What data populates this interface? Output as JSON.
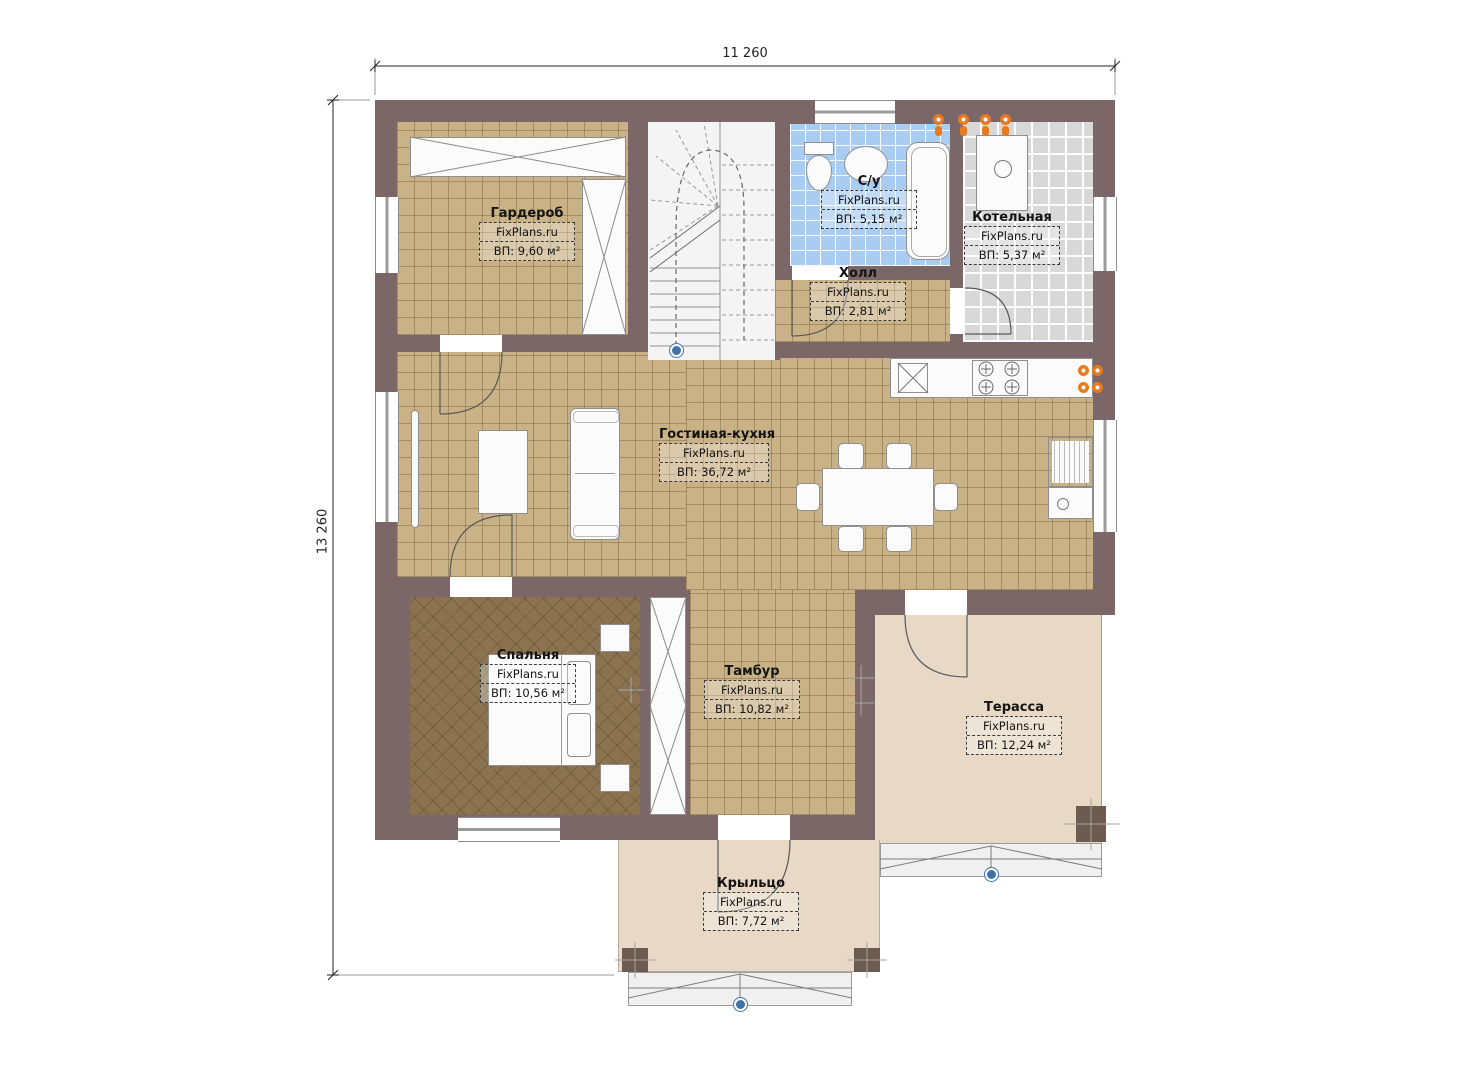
{
  "plan": {
    "dimension_width": "11 260",
    "dimension_height": "13 260",
    "watermark": "FixPlans.ru",
    "rooms": [
      {
        "id": "garderob",
        "name": "Гардероб",
        "brand": "FixPlans.ru",
        "area": "ВП: 9,60 м²"
      },
      {
        "id": "su",
        "name": "С/у",
        "brand": "FixPlans.ru",
        "area": "ВП: 5,15 м²"
      },
      {
        "id": "kotelnaya",
        "name": "Котельная",
        "brand": "FixPlans.ru",
        "area": "ВП: 5,37 м²"
      },
      {
        "id": "holl",
        "name": "Холл",
        "brand": "FixPlans.ru",
        "area": "ВП: 2,81 м²"
      },
      {
        "id": "gostinaya",
        "name": "Гостиная-кухня",
        "brand": "FixPlans.ru",
        "area": "ВП: 36,72 м²"
      },
      {
        "id": "spalnya",
        "name": "Спальня",
        "brand": "FixPlans.ru",
        "area": "ВП: 10,56 м²"
      },
      {
        "id": "tambur",
        "name": "Тамбур",
        "brand": "FixPlans.ru",
        "area": "ВП: 10,82 м²"
      },
      {
        "id": "terassa",
        "name": "Терасса",
        "brand": "FixPlans.ru",
        "area": "ВП: 12,24 м²"
      },
      {
        "id": "kryltso",
        "name": "Крыльцо",
        "brand": "FixPlans.ru",
        "area": "ВП: 7,72 м²"
      }
    ],
    "colors": {
      "wall": "#7b6768",
      "floor_tile": "#cab287",
      "bedroom_floor": "#8a734e",
      "bathroom_tile": "#a9cdf2",
      "boiler_tile": "#d8d8d8",
      "outdoor_floor": "#e7d9c5",
      "heating_marker": "#e87a1e",
      "entry_marker": "#3f72a8"
    }
  }
}
